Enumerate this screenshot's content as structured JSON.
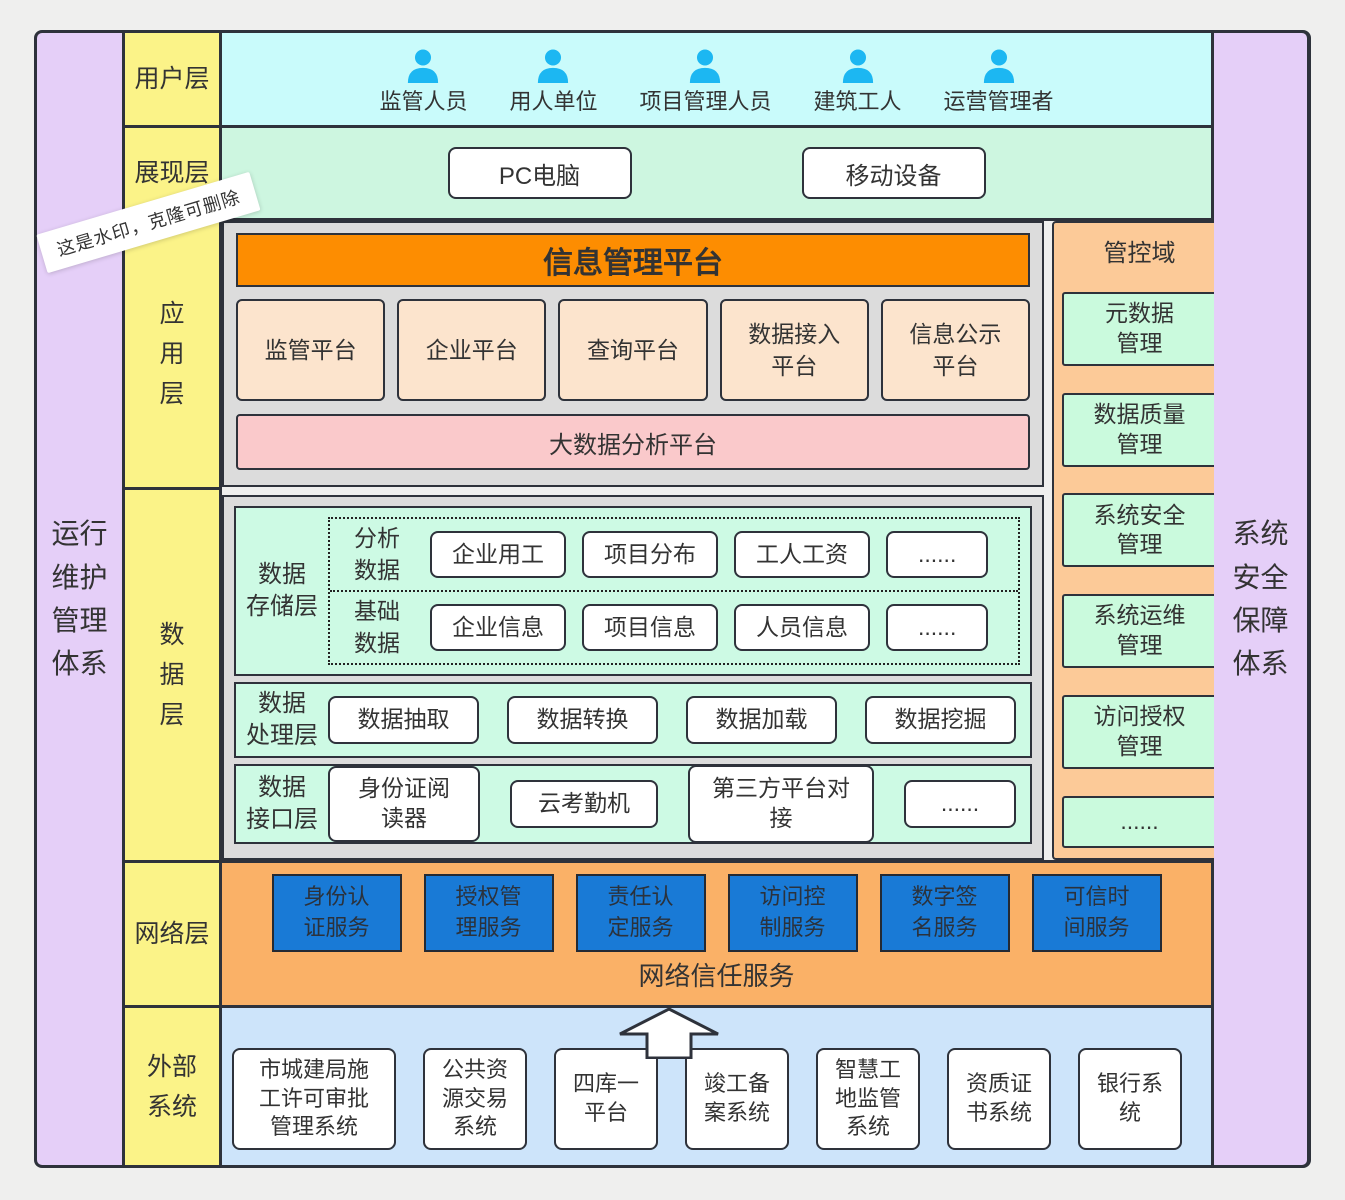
{
  "watermark": {
    "text": "这是水印，克隆可删除"
  },
  "sidebars": {
    "left": "运行\n维护\n管理\n体系",
    "right": "系统\n安全\n保障\n体系"
  },
  "layer_labels": {
    "user": "用户层",
    "presentation": "展现层",
    "application": "应\n用\n层",
    "data": "数\n据\n层",
    "network": "网络层",
    "external": "外部\n系统"
  },
  "user_layer": {
    "users": [
      "监管人员",
      "用人单位",
      "项目管理人员",
      "建筑工人",
      "运营管理者"
    ]
  },
  "presentation_layer": {
    "devices": [
      "PC电脑",
      "移动设备"
    ]
  },
  "application_layer": {
    "title": "信息管理平台",
    "platforms": [
      "监管平台",
      "企业平台",
      "查询平台",
      "数据接入\n平台",
      "信息公示\n平台"
    ],
    "bigdata_platform": "大数据分析平台"
  },
  "control_domain": {
    "title": "管控域",
    "items": [
      "元数据\n管理",
      "数据质量\n管理",
      "系统安全\n管理",
      "系统运维\n管理",
      "访问授权\n管理",
      "......"
    ]
  },
  "data_layer": {
    "storage": {
      "label": "数据\n存储层",
      "groups": [
        {
          "label": "分析\n数据",
          "items": [
            "企业用工",
            "项目分布",
            "工人工资",
            "......"
          ]
        },
        {
          "label": "基础\n数据",
          "items": [
            "企业信息",
            "项目信息",
            "人员信息",
            "......"
          ]
        }
      ]
    },
    "processing": {
      "label": "数据\n处理层",
      "items": [
        "数据抽取",
        "数据转换",
        "数据加载",
        "数据挖掘"
      ]
    },
    "interface": {
      "label": "数据\n接口层",
      "items": [
        "身份证阅\n读器",
        "云考勤机",
        "第三方平台对接",
        "......"
      ]
    }
  },
  "network_layer": {
    "services": [
      "身份认\n证服务",
      "授权管\n理服务",
      "责任认\n定服务",
      "访问控\n制服务",
      "数字签\n名服务",
      "可信时\n间服务"
    ],
    "trust_service": "网络信任服务"
  },
  "external_layer": {
    "systems": [
      "市城建局施\n工许可审批\n管理系统",
      "公共资\n源交易\n系统",
      "四库一\n平台",
      "竣工备\n案系统",
      "智慧工\n地监管\n系统",
      "资质证\n书系统",
      "银行系\n统"
    ]
  },
  "colors": {
    "border": "#2e323b",
    "background": "#efefee",
    "sidebar_purple": "#e5cff8",
    "layer_yellow": "#fbf388",
    "user_cyan": "#c9fbfb",
    "presentation_mint": "#cdf6e0",
    "container_gray": "#dcdcdc",
    "platform_orange": "#fd8d01",
    "platform_peach": "#fce4cd",
    "bigdata_pink": "#fac9cb",
    "data_mint": "#cdfae4",
    "network_orange": "#fab167",
    "control_orange": "#fcca98",
    "control_green": "#cafadd",
    "service_blue": "#197ad6",
    "external_blue": "#cde4fa",
    "user_icon_blue": "#1cb7f2"
  }
}
